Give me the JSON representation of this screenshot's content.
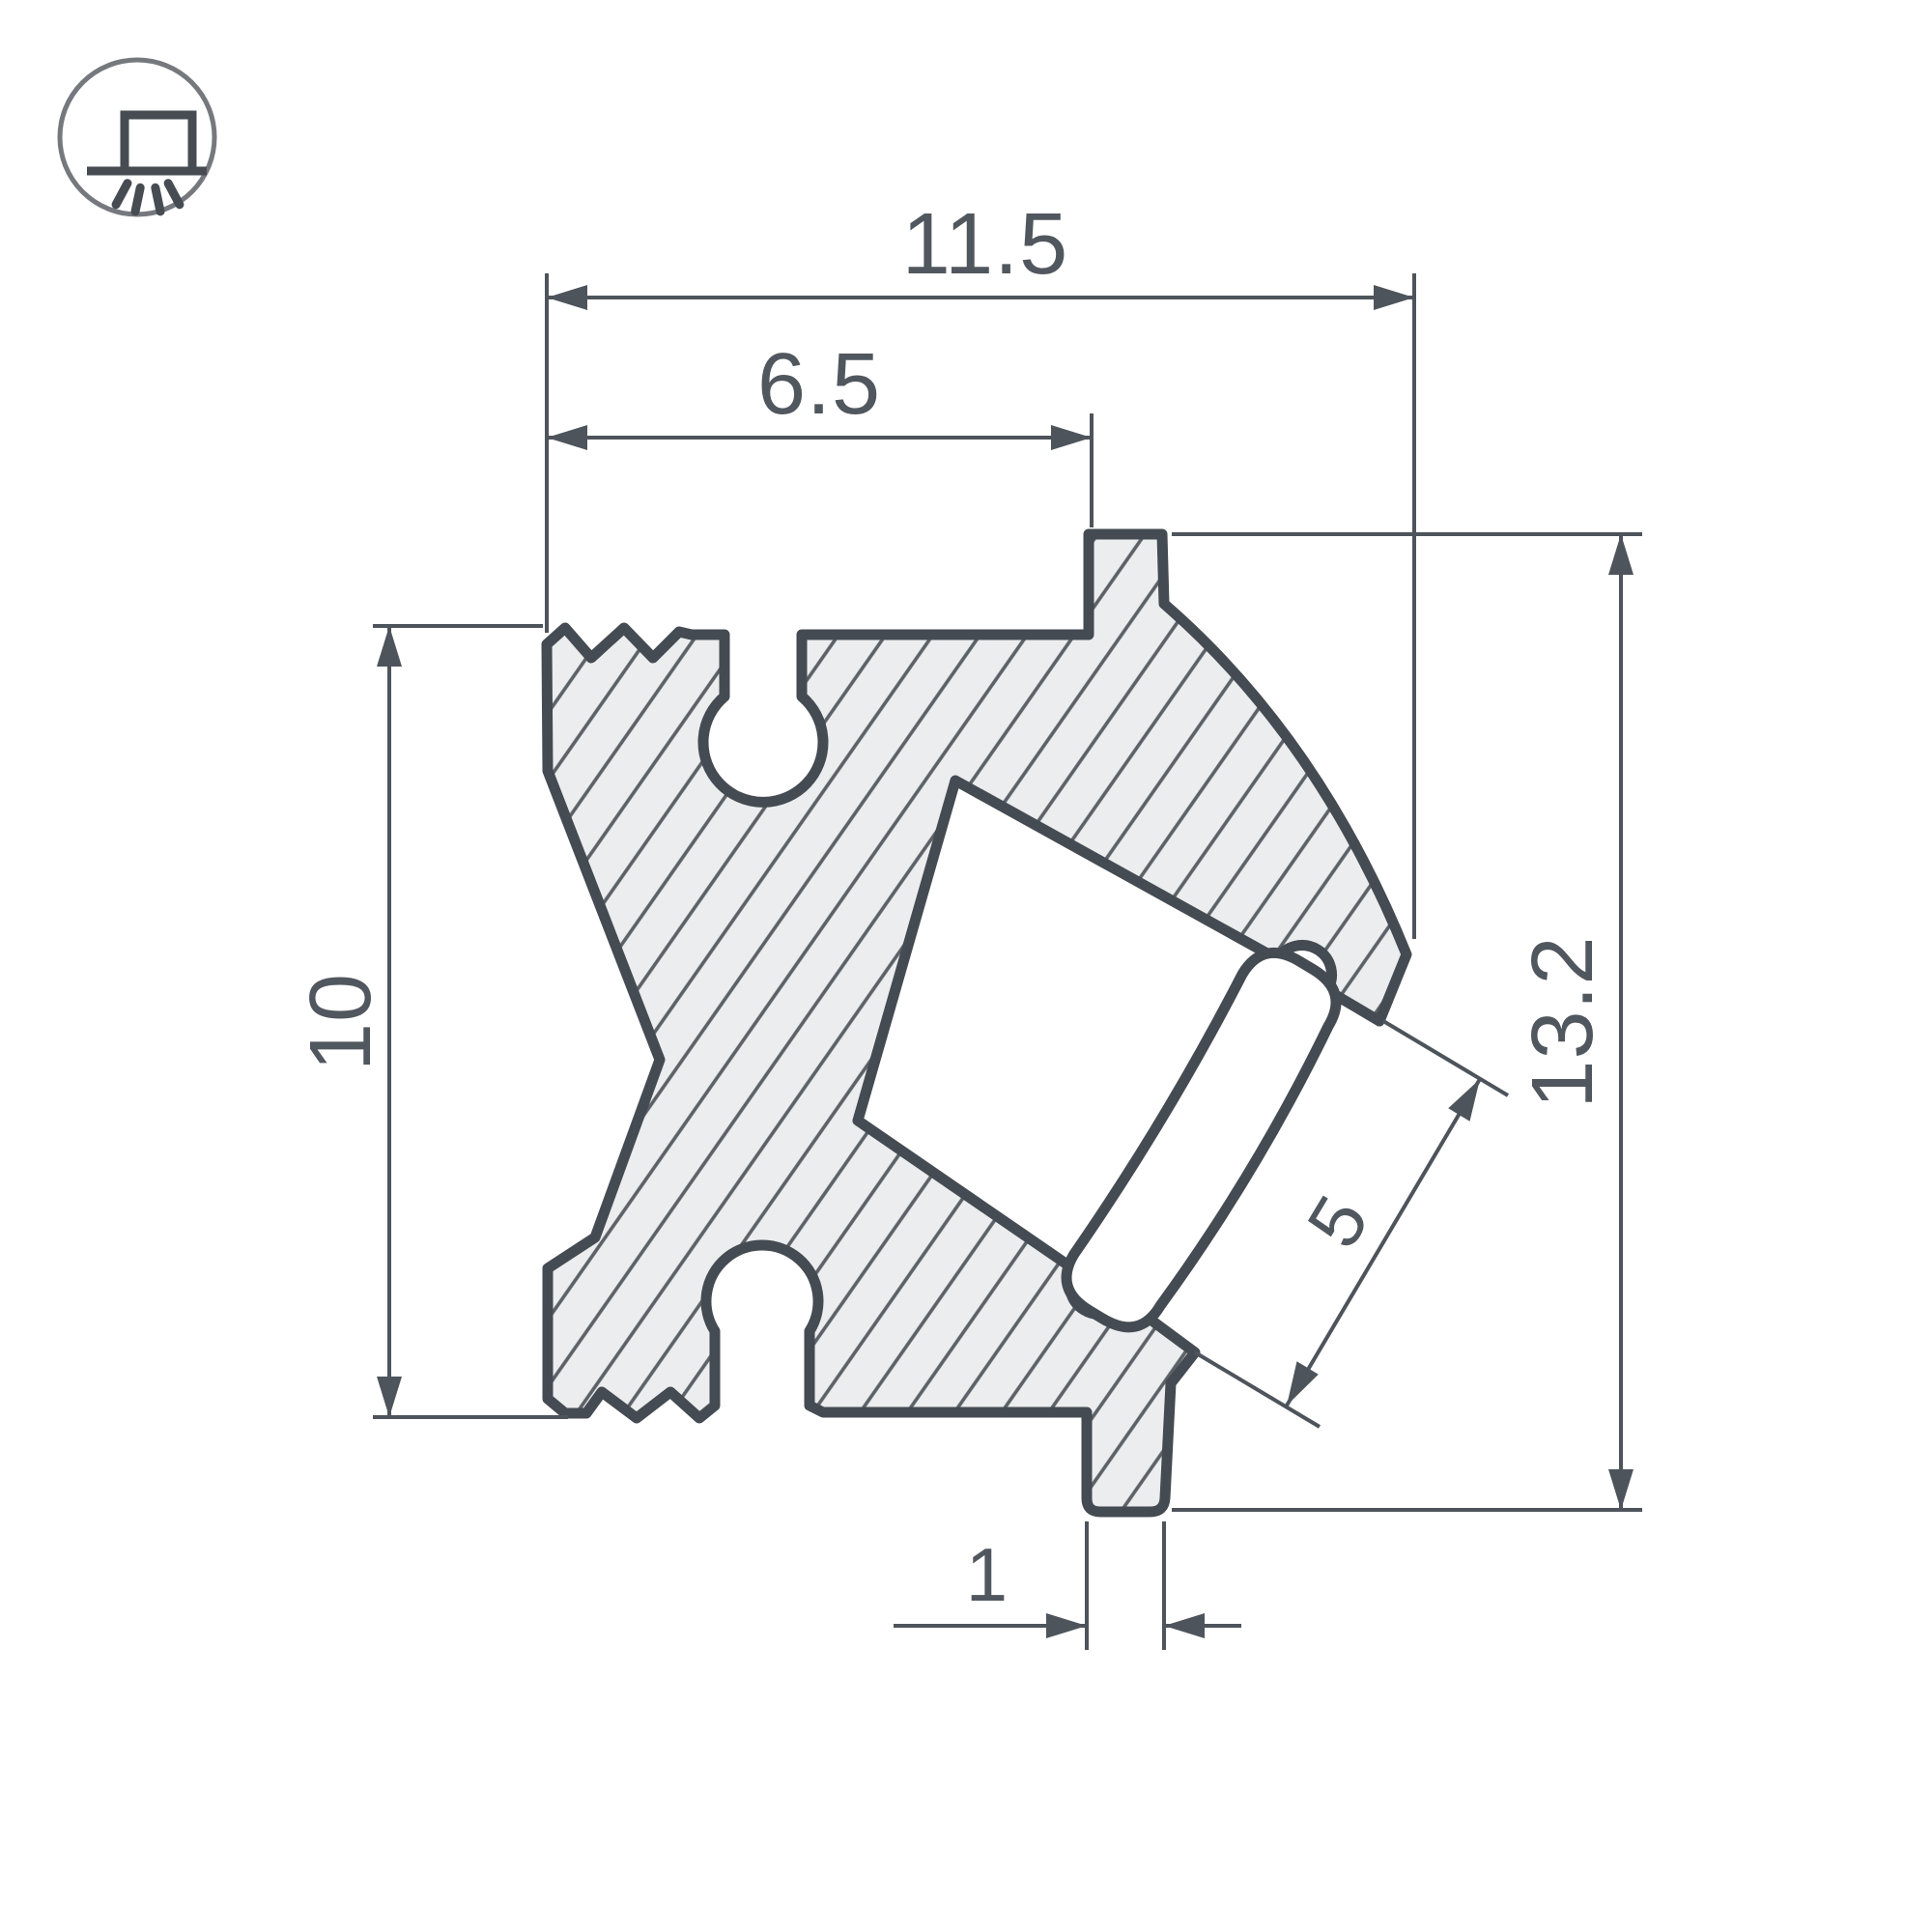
{
  "drawing": {
    "type": "profile-cross-section-technical-drawing",
    "dimensions": {
      "overall_width": "11.5",
      "inner_width": "6.5",
      "left_height": "10",
      "overall_height": "13.2",
      "channel_opening": "5",
      "foot_width": "1"
    },
    "icon": {
      "name": "surface-mounted-light-icon"
    },
    "colors": {
      "line": "#454b52",
      "dimension_line": "#4e545b",
      "text": "#51575e",
      "body_fill": "#ebedee",
      "hatch_line": "#5c6167",
      "icon_circle": "#75797e",
      "background": "#ffffff"
    }
  }
}
